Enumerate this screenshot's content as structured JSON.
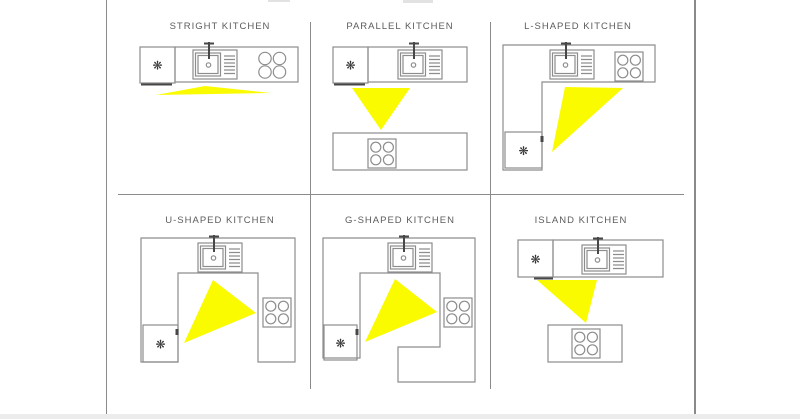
{
  "diagram": {
    "type": "kitchen-layout-comparison",
    "snowflake_glyph": "❋",
    "colors": {
      "background": "#ffffff",
      "work_triangle": "#fbfb00",
      "outline": "#8d8d8d",
      "frame": "#8a8a8a",
      "title_text": "#5c5c5c",
      "appliance_detail": "#474747",
      "bottom_band": "#ececec"
    },
    "icons": {
      "refrigerator": "snowflake-icon",
      "sink": "sink-basin-icon",
      "cooktop": "four-burner-icon",
      "highlight": "work-triangle"
    }
  },
  "panels": [
    {
      "title": "STRIGHT KITCHEN",
      "layout": "straight",
      "appliances": [
        "refrigerator",
        "sink",
        "cooktop"
      ]
    },
    {
      "title": "PARALLEL KITCHEN",
      "layout": "parallel",
      "appliances": [
        "refrigerator",
        "sink",
        "cooktop"
      ]
    },
    {
      "title": "L-SHAPED KITCHEN",
      "layout": "l-shaped",
      "appliances": [
        "refrigerator",
        "sink",
        "cooktop"
      ]
    },
    {
      "title": "U-SHAPED KITCHEN",
      "layout": "u-shaped",
      "appliances": [
        "refrigerator",
        "sink",
        "cooktop"
      ]
    },
    {
      "title": "G-SHAPED KITCHEN",
      "layout": "g-shaped",
      "appliances": [
        "refrigerator",
        "sink",
        "cooktop"
      ]
    },
    {
      "title": "ISLAND KITCHEN",
      "layout": "island",
      "appliances": [
        "refrigerator",
        "sink",
        "cooktop"
      ]
    }
  ]
}
